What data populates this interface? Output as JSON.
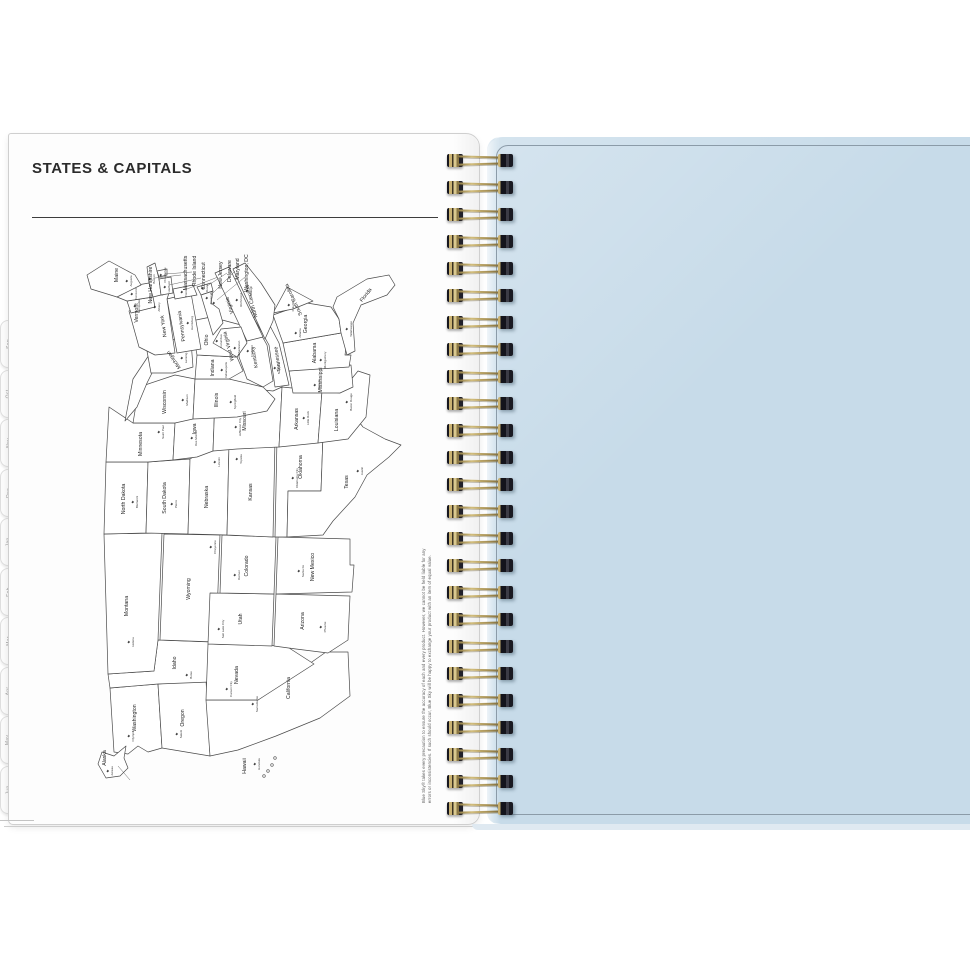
{
  "header": {
    "title": "STATES & CAPITALS"
  },
  "left_page": {
    "tabs": [
      "Sep",
      "Oct",
      "Nov",
      "Dec",
      "Jan",
      "Feb",
      "Mar",
      "Apr",
      "May",
      "Jun"
    ],
    "disclaimer": {
      "line1": "Blue Sky® takes every precaution to ensure the accuracy of each and every product. However, we cannot be held liable for any",
      "line2": "errors or inconsistencies. If such should occur, Blue Sky will be happy to exchange your product with an item of equal value."
    }
  },
  "binding": {
    "loop_count": 25
  },
  "right_page": {
    "color": "#c7dbe9",
    "border_color": "#8b9ba8"
  },
  "map": {
    "title": "United States states and capitals (map rotated 90° counterclockwise)",
    "states": [
      {
        "name": "Washington",
        "capital": "Olympia",
        "label": [
          74,
          60
        ],
        "star": [
          56,
          54
        ]
      },
      {
        "name": "Oregon",
        "capital": "Salem",
        "label": [
          74,
          108
        ],
        "star": [
          58,
          102
        ]
      },
      {
        "name": "California",
        "capital": "Sacramento",
        "label": [
          104,
          214
        ],
        "star": [
          88,
          178
        ]
      },
      {
        "name": "Idaho",
        "capital": "Boise",
        "label": [
          129,
          100
        ],
        "star": [
          117,
          112
        ]
      },
      {
        "name": "Nevada",
        "capital": "Carson City",
        "label": [
          117,
          162
        ],
        "star": [
          103,
          152
        ]
      },
      {
        "name": "Utah",
        "capital": "Salt Lake City",
        "label": [
          173,
          166
        ],
        "star": [
          163,
          144
        ]
      },
      {
        "name": "Arizona",
        "capital": "Phoenix",
        "label": [
          171,
          228
        ],
        "star": [
          165,
          246
        ]
      },
      {
        "name": "Montana",
        "capital": "Helena",
        "label": [
          186,
          52
        ],
        "star": [
          150,
          54
        ]
      },
      {
        "name": "Wyoming",
        "capital": "Cheyenne",
        "label": [
          203,
          114
        ],
        "star": [
          245,
          136
        ]
      },
      {
        "name": "Colorado",
        "capital": "Denver",
        "label": [
          226,
          172
        ],
        "star": [
          217,
          160
        ]
      },
      {
        "name": "New Mexico",
        "capital": "Santa Fe",
        "label": [
          225,
          238
        ],
        "star": [
          221,
          224
        ]
      },
      {
        "name": "North Dakota",
        "capital": "Bismarck",
        "label": [
          293,
          49
        ],
        "star": [
          290,
          58
        ]
      },
      {
        "name": "South Dakota",
        "capital": "Pierre",
        "label": [
          294,
          90
        ],
        "star": [
          288,
          97
        ]
      },
      {
        "name": "Nebraska",
        "capital": "Lincoln",
        "label": [
          295,
          132
        ],
        "star": [
          330,
          140
        ]
      },
      {
        "name": "Kansas",
        "capital": "Topeka",
        "label": [
          300,
          176
        ],
        "star": [
          333,
          162
        ]
      },
      {
        "name": "Oklahoma",
        "capital": "Oklahoma City",
        "label": [
          325,
          226
        ],
        "star": [
          314,
          218
        ]
      },
      {
        "name": "Texas",
        "capital": "Austin",
        "label": [
          310,
          272
        ],
        "star": [
          321,
          283
        ]
      },
      {
        "name": "Minnesota",
        "capital": "Saint Paul",
        "label": [
          348,
          66
        ],
        "star": [
          360,
          84
        ]
      },
      {
        "name": "Iowa",
        "capital": "Des Moines",
        "label": [
          363,
          120
        ],
        "star": [
          354,
          117
        ]
      },
      {
        "name": "Missouri",
        "capital": "Jefferson City",
        "label": [
          371,
          170
        ],
        "star": [
          365,
          161
        ]
      },
      {
        "name": "Arkansas",
        "capital": "Little Rock",
        "label": [
          373,
          222
        ],
        "star": [
          374,
          229
        ]
      },
      {
        "name": "Louisiana",
        "capital": "Baton Rouge",
        "label": [
          372,
          262
        ],
        "star": [
          390,
          272
        ]
      },
      {
        "name": "Wisconsin",
        "capital": "Madison",
        "label": [
          390,
          90
        ],
        "star": [
          392,
          108
        ]
      },
      {
        "name": "Illinois",
        "capital": "Springfield",
        "label": [
          392,
          142
        ],
        "star": [
          390,
          156
        ]
      },
      {
        "name": "Michigan",
        "capital": "Lansing",
        "label": [
          433,
          99
        ],
        "rot": -35,
        "star": [
          434,
          107
        ]
      },
      {
        "name": "Indiana",
        "capital": "Indianapolis",
        "label": [
          424,
          138
        ],
        "star": [
          422,
          147
        ]
      },
      {
        "name": "Ohio",
        "capital": "Columbus",
        "label": [
          452,
          132
        ],
        "star": [
          451,
          142
        ]
      },
      {
        "name": "Kentucky",
        "capital": "Frankfort",
        "label": [
          435,
          180
        ],
        "rot": -10,
        "star": [
          441,
          173
        ]
      },
      {
        "name": "Tennessee",
        "capital": "Nashville",
        "label": [
          433,
          203
        ],
        "rot": -8,
        "star": [
          424,
          200
        ]
      },
      {
        "name": "Mississippi",
        "capital": "Jackson",
        "label": [
          412,
          246
        ],
        "star": [
          407,
          240
        ]
      },
      {
        "name": "Alabama",
        "capital": "Montgomery",
        "label": [
          439,
          240
        ],
        "star": [
          432,
          246
        ]
      },
      {
        "name": "Georgia",
        "capital": "Atlanta",
        "label": [
          468,
          231
        ],
        "star": [
          459,
          221
        ]
      },
      {
        "name": "Florida",
        "capital": "Tallahassee",
        "label": [
          496,
          291
        ],
        "rot": 38,
        "star": [
          463,
          272
        ]
      },
      {
        "name": "South Carolina",
        "capital": "Columbia",
        "label": [
          493,
          219
        ],
        "rot": -25,
        "star": [
          487,
          214
        ]
      },
      {
        "name": "North Carolina",
        "capital": "Raleigh",
        "label": [
          491,
          177
        ],
        "rot": -15,
        "star": [
          501,
          172
        ]
      },
      {
        "name": "Virginia",
        "capital": "Richmond",
        "label": [
          487,
          155
        ],
        "rot": -18,
        "star": [
          492,
          162
        ]
      },
      {
        "name": "West Virginia",
        "capital": "Charleston",
        "label": [
          446,
          154
        ],
        "rot": -15,
        "star": [
          444,
          160
        ]
      },
      {
        "name": "Pennsylvania",
        "capital": "Harrisburg",
        "label": [
          466,
          107
        ],
        "rot": -8,
        "star": [
          469,
          113
        ]
      },
      {
        "name": "New York",
        "capital": "Albany",
        "label": [
          466,
          89
        ],
        "rot": -8,
        "star": [
          485,
          80
        ]
      },
      {
        "name": "Vermont",
        "capital": "Montpelier",
        "label": [
          479,
          62
        ],
        "star": [
          486,
          60
        ]
      },
      {
        "name": "New Hampshire",
        "capital": "Concord",
        "label": [
          507,
          76
        ],
        "star": [
          498,
          57
        ]
      },
      {
        "name": "Maine",
        "capital": "Augusta",
        "label": [
          517,
          42
        ],
        "star": [
          511,
          52
        ]
      },
      {
        "name": "Massachusetts",
        "capital": "Boston",
        "label": [
          519,
          111
        ],
        "star": [
          513,
          75
        ],
        "leader": [
          514,
          79,
          517,
          105
        ]
      },
      {
        "name": "Rhode Island",
        "capital": "Providence",
        "label": [
          521,
          120
        ],
        "star": [
          517,
          86
        ],
        "leader": [
          518,
          89,
          520,
          116
        ]
      },
      {
        "name": "Connecticut",
        "capital": "Hartford",
        "label": [
          516,
          129
        ],
        "star": [
          505,
          90
        ],
        "leader": [
          507,
          93,
          514,
          125
        ]
      },
      {
        "name": "New Jersey",
        "capital": "Trenton",
        "label": [
          517,
          146
        ],
        "star": [
          500,
          107
        ],
        "leader": [
          503,
          111,
          515,
          142
        ]
      },
      {
        "name": "Delaware",
        "capital": "Dover",
        "label": [
          521,
          155
        ],
        "star": [
          504,
          128
        ],
        "leader": [
          506,
          131,
          519,
          151
        ]
      },
      {
        "name": "Maryland",
        "capital": "Annapolis",
        "label": [
          523,
          163
        ],
        "star": [
          494,
          132
        ],
        "leader": [
          497,
          135,
          521,
          159
        ]
      },
      {
        "name": "Washington, DC",
        "capital": "",
        "label": [
          519,
          172
        ],
        "star": [
          489,
          139
        ],
        "leader": [
          492,
          141,
          515,
          169
        ]
      },
      {
        "name": "Alaska",
        "capital": "Juneau",
        "label": [
          34,
          30
        ],
        "star": [
          21,
          33
        ],
        "leader": [
          26,
          42,
          12,
          54
        ]
      },
      {
        "name": "Hawaii",
        "capital": "Honolulu",
        "label": [
          26,
          170
        ],
        "star": [
          28,
          180
        ]
      }
    ]
  }
}
